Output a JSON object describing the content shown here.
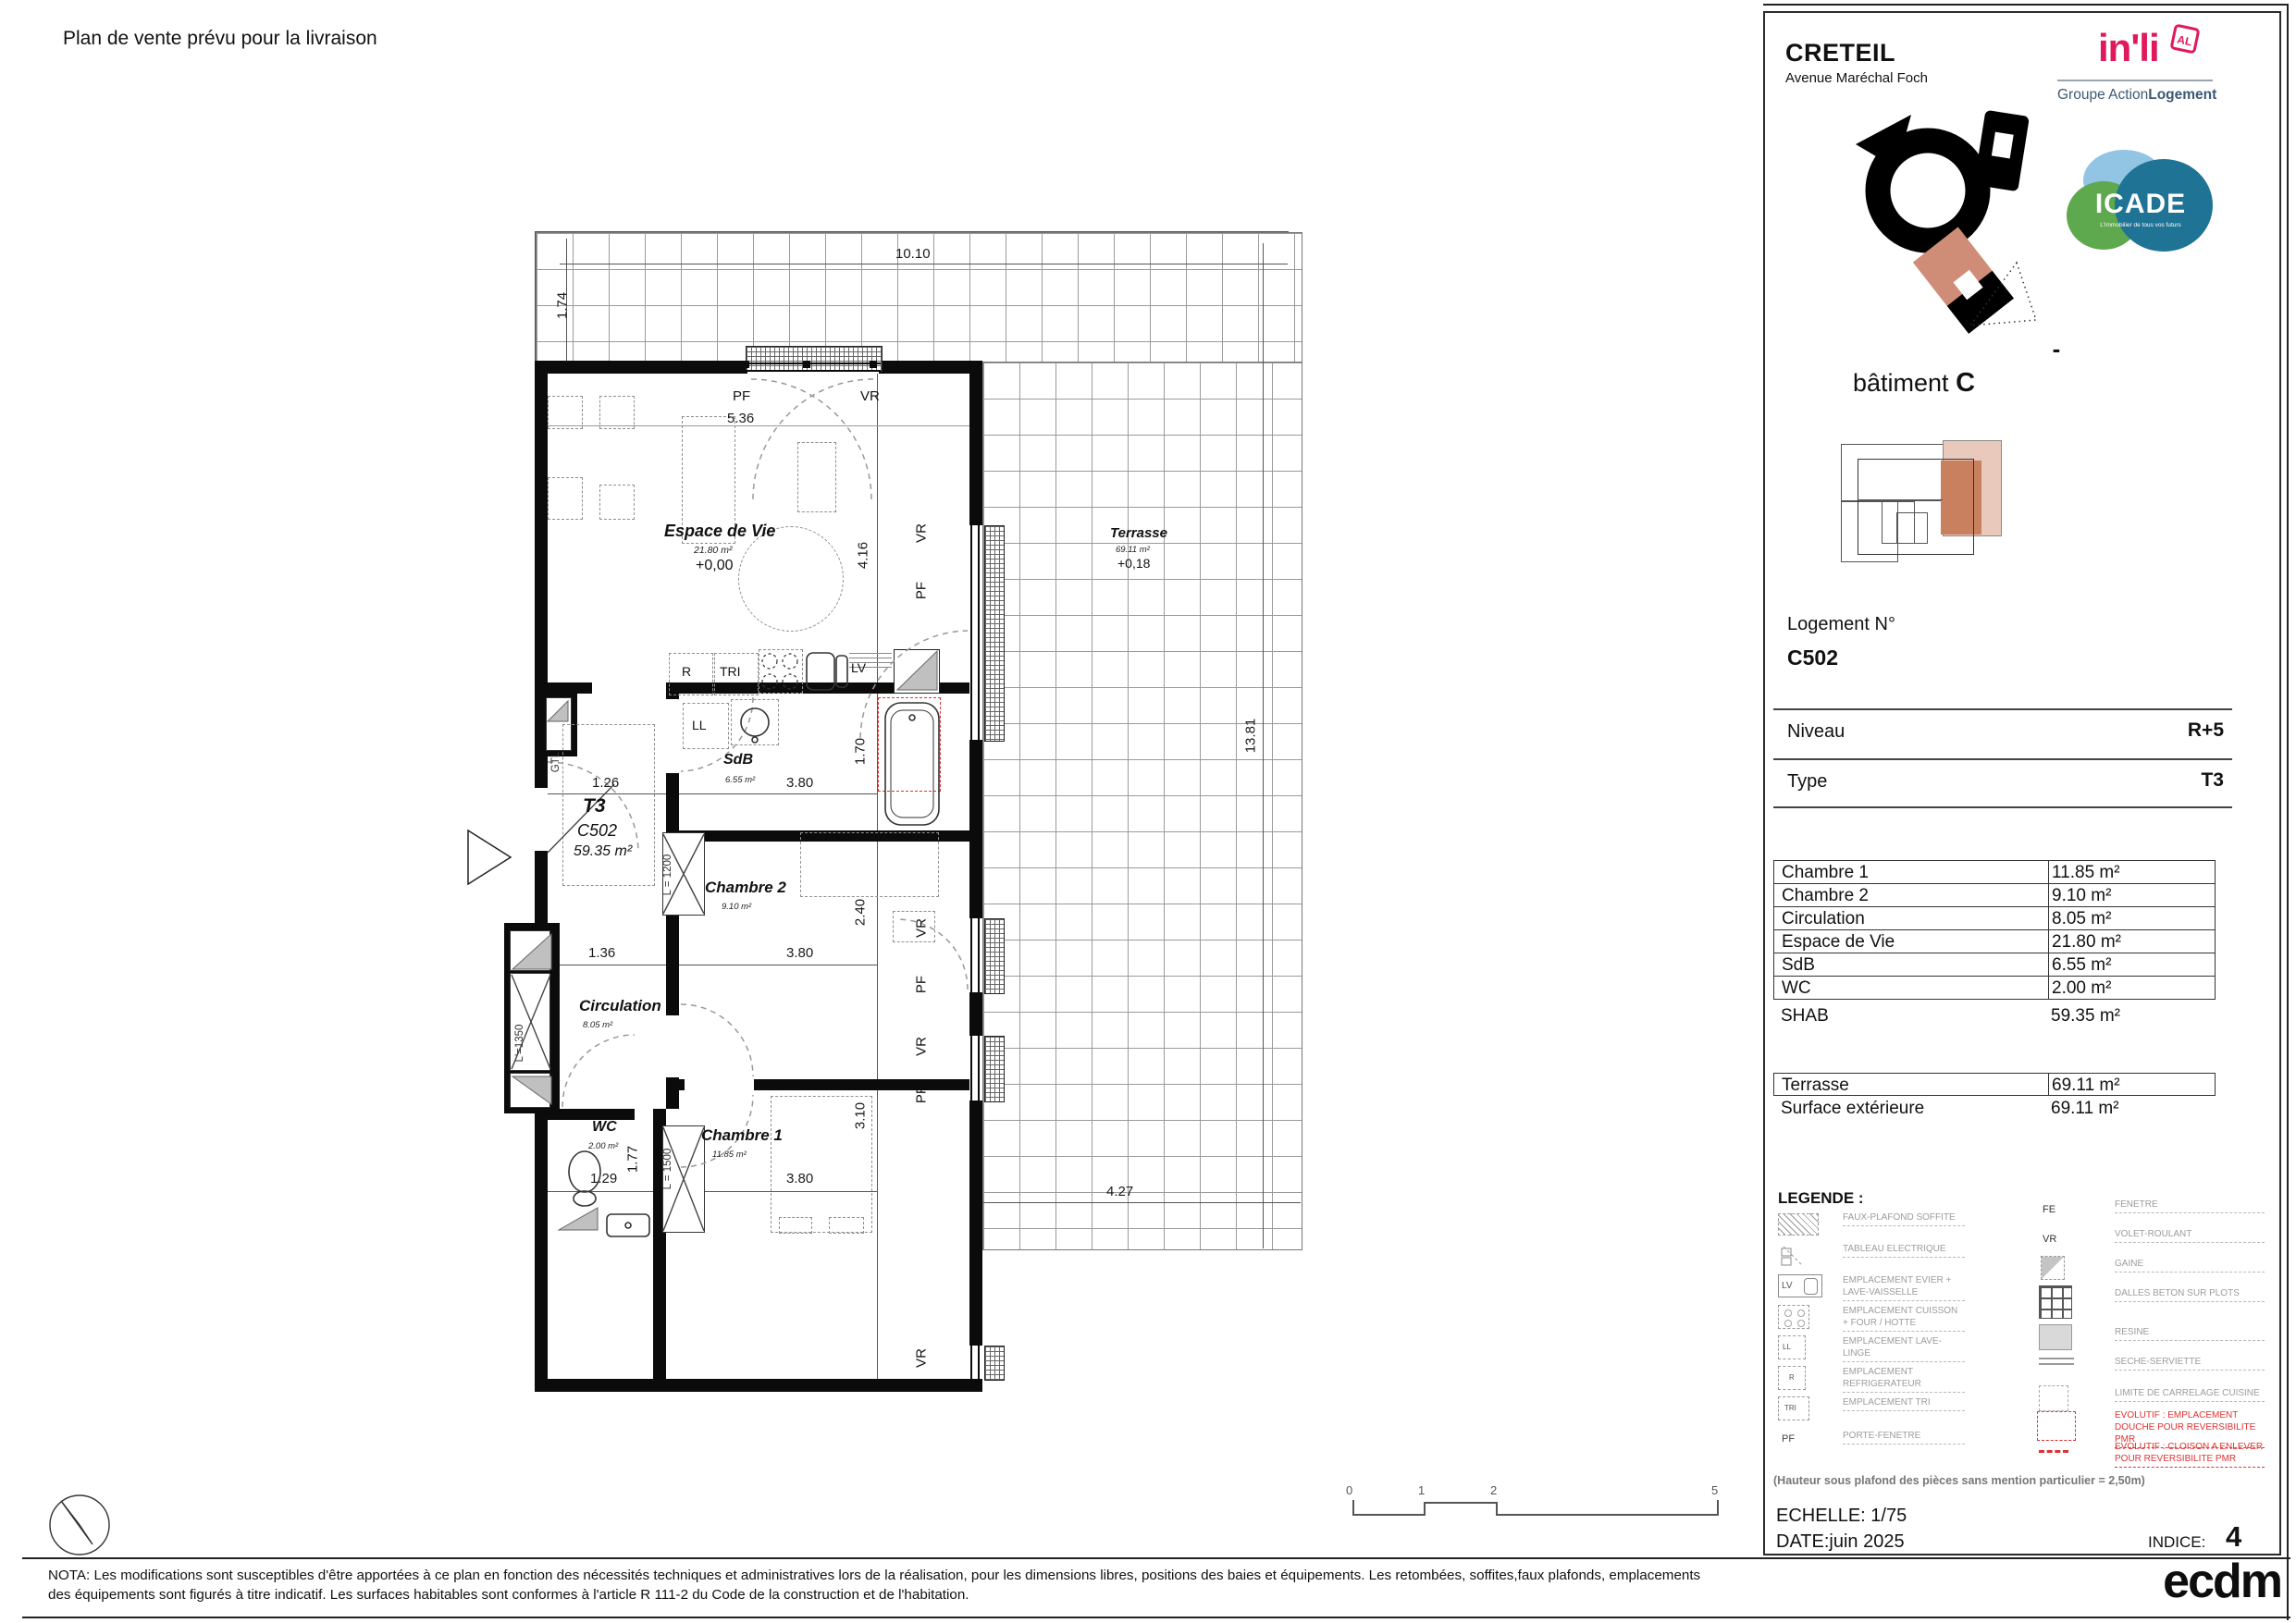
{
  "page": {
    "note_top": "Plan de vente prévu pour la livraison",
    "nota": "NOTA: Les modifications sont susceptibles d'être apportées à ce plan en fonction des nécessités techniques et administratives lors de la réalisation, pour les dimensions libres, positions des baies et équipements. Les retombées, soffites,faux plafonds, emplacements des équipements sont figurés à titre indicatif. Les surfaces habitables sont conformes à l'article R 111-2 du Code de la construction et de l'habitation."
  },
  "header": {
    "city": "CRETEIL",
    "address": "Avenue Maréchal Foch",
    "inli": "in'li",
    "inli_badge": "AL",
    "group_prefix": "Groupe Action",
    "group_bold": "Logement",
    "icade": "ICADE",
    "icade_tagline": "L'immobilier de tous vos futurs",
    "dash": "-",
    "building_label": "bâtiment ",
    "building_value": "C"
  },
  "unit": {
    "label": "Logement N°",
    "number": "C502",
    "level_label": "Niveau",
    "level_value": "R+5",
    "type_label": "Type",
    "type_value": "T3"
  },
  "areas": {
    "rows": [
      {
        "label": "Chambre 1",
        "value": "11.85 m²"
      },
      {
        "label": "Chambre 2",
        "value": "9.10 m²"
      },
      {
        "label": "Circulation",
        "value": "8.05 m²"
      },
      {
        "label": "Espace de Vie",
        "value": "21.80 m²"
      },
      {
        "label": "SdB",
        "value": "6.55 m²"
      },
      {
        "label": "WC",
        "value": "2.00 m²"
      }
    ],
    "shab": {
      "label": "SHAB",
      "value": "59.35 m²"
    },
    "terrasse": {
      "label": "Terrasse",
      "value": "69.11 m²"
    },
    "exterieure": {
      "label": "Surface extérieure",
      "value": "69.11 m²"
    }
  },
  "legend": {
    "title": "LEGENDE :",
    "left": [
      {
        "label": "FAUX-PLAFOND SOFFITE"
      },
      {
        "label": "TABLEAU ELECTRIQUE"
      },
      {
        "label": "EMPLACEMENT EVIER + LAVE-VAISSELLE"
      },
      {
        "label": "EMPLACEMENT CUISSON + FOUR / HOTTE"
      },
      {
        "label": "EMPLACEMENT LAVE-LINGE"
      },
      {
        "label": "EMPLACEMENT REFRIGERATEUR"
      },
      {
        "label": "EMPLACEMENT TRI"
      },
      {
        "label": "PORTE-FENETRE"
      }
    ],
    "right": [
      {
        "label": "FENETRE"
      },
      {
        "label": "VOLET-ROULANT"
      },
      {
        "label": "GAINE"
      },
      {
        "label": "DALLES BETON SUR PLOTS"
      },
      {
        "label": "RESINE"
      },
      {
        "label": "SECHE-SERVIETTE"
      },
      {
        "label": "LIMITE DE CARRELAGE CUISINE"
      },
      {
        "label": "EVOLUTIF : EMPLACEMENT DOUCHE POUR REVERSIBILITE PMR"
      },
      {
        "label": "EVOLUTIF : CLOISON A ENLEVER POUR REVERSIBILITE PMR"
      }
    ],
    "ceiling_note": "(Hauteur sous plafond des pièces sans mention particulier = 2,50m)"
  },
  "titleblock": {
    "echelle": "ECHELLE: 1/75",
    "date": "DATE:juin 2025",
    "indice_label": "INDICE:",
    "indice_value": "4",
    "firm": "ecdm"
  },
  "scalebar": {
    "t0": "0",
    "t1": "1",
    "t2": "2",
    "t5": "5"
  },
  "plan": {
    "rooms": {
      "espace": {
        "name": "Espace de Vie",
        "area": "21.80 m²",
        "level": "+0,00"
      },
      "terrasse": {
        "name": "Terrasse",
        "area": "69.11 m²",
        "level": "+0,18"
      },
      "sdb": {
        "name": "SdB",
        "area": "6.55 m²"
      },
      "chambre2": {
        "name": "Chambre 2",
        "area": "9.10 m²"
      },
      "circulation": {
        "name": "Circulation",
        "area": "8.05 m²"
      },
      "wc": {
        "name": "WC",
        "area": "2.00 m²"
      },
      "chambre1": {
        "name": "Chambre 1",
        "area": "11.85 m²"
      },
      "unit": {
        "type": "T3",
        "number": "C502",
        "area": "59.35 m²"
      }
    },
    "dims": {
      "top": "10.10",
      "left": "1.74",
      "living_w": "5.36",
      "living_h": "4.16",
      "terrace_h": "13.81",
      "hall": "1.26",
      "sdb_w": "3.80",
      "sdb_h": "1.70",
      "ch2_w": "3.80",
      "ch2_h": "2.40",
      "circ": "1.36",
      "ch1_w": "3.80",
      "ch1_h": "3.10",
      "wc_w": "1.29",
      "wc_h": "1.77",
      "terrace_b": "4.27",
      "l1200": "L = 1200",
      "l1500": "L = 1500",
      "l1350": "L'=1350"
    },
    "tags": {
      "pf": "PF",
      "vr": "VR",
      "fe": "FE",
      "gtl": "GTL",
      "ll": "LL",
      "lv": "LV",
      "r": "R",
      "tri": "TRI"
    }
  }
}
